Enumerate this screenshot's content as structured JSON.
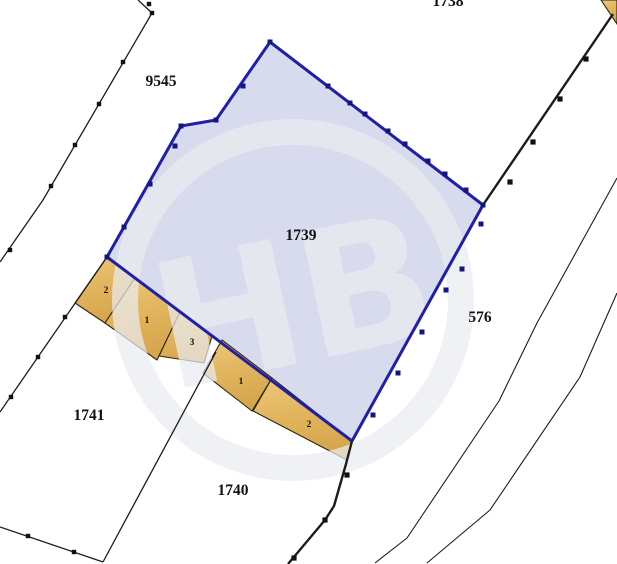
{
  "map": {
    "canvas": {
      "width": 617,
      "height": 564,
      "background": "#ffffff"
    },
    "colors": {
      "parcel_fill": "#d8daed",
      "parcel_border": "#1f1fa8",
      "parcel_tick": "#15157e",
      "building_fill_top": "#ecc97a",
      "building_fill_mid": "#e2b55e",
      "building_fill_bottom": "#d6a64d",
      "building_border": "#2e2410",
      "boundary_line": "#1c1c1c",
      "tick": "#111111",
      "label": "#111111",
      "watermark": "#eaecf1"
    },
    "highlighted_parcel": {
      "label": "1739",
      "label_pos": [
        301,
        240
      ],
      "polygon": [
        [
          270,
          42
        ],
        [
          216,
          120
        ],
        [
          181,
          126
        ],
        [
          107,
          257
        ],
        [
          352,
          441
        ],
        [
          483,
          205
        ]
      ],
      "ticks": [
        [
          270,
          42
        ],
        [
          216,
          120
        ],
        [
          181,
          126
        ],
        [
          107,
          257
        ],
        [
          483,
          205
        ],
        [
          243,
          86
        ],
        [
          328,
          86
        ],
        [
          350,
          103
        ],
        [
          365,
          114
        ],
        [
          388,
          131
        ],
        [
          405,
          144
        ],
        [
          428,
          161
        ],
        [
          445,
          174
        ],
        [
          466,
          190
        ],
        [
          175,
          146
        ],
        [
          150,
          184
        ],
        [
          124,
          227
        ],
        [
          373,
          415
        ],
        [
          398,
          373
        ],
        [
          422,
          332
        ],
        [
          446,
          290
        ],
        [
          462,
          269
        ],
        [
          481,
          224
        ]
      ]
    },
    "parcels": [
      {
        "label": "1738",
        "pos": [
          448,
          6
        ]
      },
      {
        "label": "9545",
        "pos": [
          161,
          86
        ]
      },
      {
        "label": "576",
        "pos": [
          480,
          322
        ]
      },
      {
        "label": "1741",
        "pos": [
          89,
          420
        ]
      },
      {
        "label": "1740",
        "pos": [
          233,
          495
        ]
      }
    ],
    "buildings": [
      {
        "label": "2",
        "label_pos": [
          106,
          293
        ],
        "polygon": [
          [
            107,
            257
          ],
          [
            135,
            278
          ],
          [
            105,
            323
          ],
          [
            75,
            303
          ]
        ]
      },
      {
        "label": "1",
        "label_pos": [
          147,
          323
        ],
        "polygon": [
          [
            135,
            278
          ],
          [
            180,
            312
          ],
          [
            157,
            360
          ],
          [
            105,
            323
          ]
        ]
      },
      {
        "label": "3",
        "label_pos": [
          192,
          345
        ],
        "polygon": [
          [
            180,
            312
          ],
          [
            212,
            336
          ],
          [
            204,
            363
          ],
          [
            159,
            356
          ]
        ]
      },
      {
        "label": "1",
        "label_pos": [
          241,
          384
        ],
        "polygon": [
          [
            222,
            340
          ],
          [
            272,
            378
          ],
          [
            252,
            411
          ],
          [
            203,
            373
          ]
        ]
      },
      {
        "label": "2",
        "label_pos": [
          309,
          427
        ],
        "polygon": [
          [
            272,
            378
          ],
          [
            352,
            441
          ],
          [
            347,
            460
          ],
          [
            253,
            411
          ]
        ]
      }
    ],
    "corner_building": {
      "polygon": [
        [
          601,
          0
        ],
        [
          617,
          0
        ],
        [
          617,
          24
        ]
      ]
    },
    "boundary_lines": [
      {
        "name": "west-boundary-line",
        "width": 1.3,
        "points": [
          [
            138,
            0
          ],
          [
            152,
            13
          ],
          [
            43,
            200
          ],
          [
            0,
            262
          ]
        ],
        "ticks": [
          [
            149,
            4
          ],
          [
            152,
            13
          ],
          [
            123,
            62
          ],
          [
            99,
            104
          ],
          [
            75,
            145
          ],
          [
            51,
            186
          ],
          [
            10,
            250
          ]
        ]
      },
      {
        "name": "southwest-divider-line",
        "width": 1.3,
        "points": [
          [
            107,
            257
          ],
          [
            0,
            412
          ]
        ],
        "ticks": [
          [
            65,
            317
          ],
          [
            38,
            357
          ],
          [
            11,
            397
          ]
        ]
      },
      {
        "name": "parcel-1741-east-line",
        "width": 1.3,
        "points": [
          [
            216,
            352
          ],
          [
            103,
            562
          ]
        ],
        "ticks": []
      },
      {
        "name": "parcel-1741-south-line",
        "width": 1.3,
        "points": [
          [
            0,
            527
          ],
          [
            103,
            562
          ]
        ],
        "ticks": [
          [
            28,
            536
          ],
          [
            74,
            552
          ]
        ]
      },
      {
        "name": "southeast-thick-line",
        "width": 2.4,
        "points": [
          [
            352,
            441
          ],
          [
            346,
            464
          ],
          [
            334,
            506
          ],
          [
            325,
            520
          ],
          [
            288,
            564
          ]
        ],
        "ticks": [
          [
            347,
            475
          ],
          [
            325,
            520
          ],
          [
            294,
            558
          ]
        ]
      },
      {
        "name": "northeast-thick-line",
        "width": 2.4,
        "points": [
          [
            613,
            14
          ],
          [
            483,
            205
          ]
        ],
        "ticks": [
          [
            586,
            59
          ],
          [
            560,
            99
          ],
          [
            533,
            142
          ],
          [
            510,
            182
          ]
        ]
      },
      {
        "name": "east-thin-line-1",
        "width": 1.1,
        "points": [
          [
            617,
            178
          ],
          [
            537,
            323
          ],
          [
            499,
            401
          ],
          [
            407,
            538
          ],
          [
            375,
            563
          ]
        ],
        "ticks": []
      },
      {
        "name": "east-thin-line-2",
        "width": 1.1,
        "points": [
          [
            617,
            293
          ],
          [
            580,
            377
          ],
          [
            490,
            510
          ],
          [
            427,
            563
          ]
        ],
        "ticks": []
      }
    ],
    "watermark": {
      "center": [
        293,
        300
      ],
      "radius": 168,
      "ring_width": 26,
      "letters": "НВ",
      "font_size": 175,
      "rotation": -12,
      "opacity": 0.72
    }
  }
}
